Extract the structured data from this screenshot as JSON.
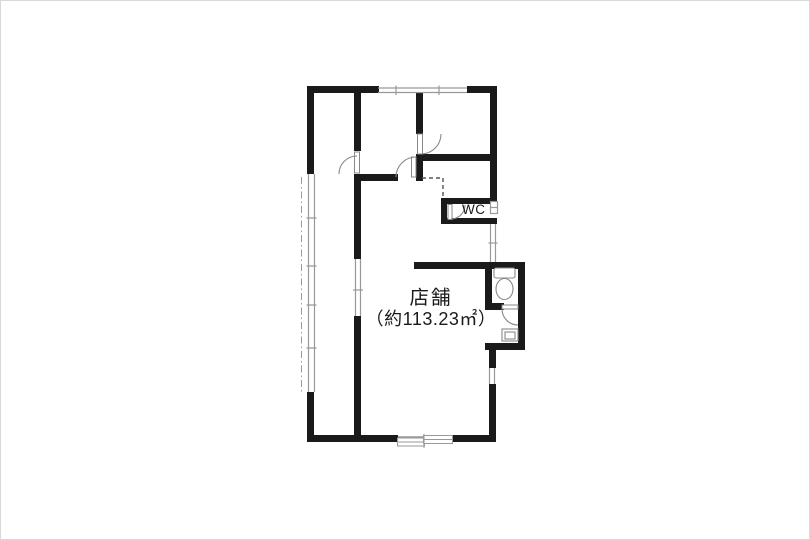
{
  "floorplan": {
    "room_label": "店舗",
    "room_area": "（約113.23㎡）",
    "wc_label": "WC",
    "colors": {
      "wall": "#1a1a1a",
      "window": "#999999",
      "door": "#888888",
      "dash": "#555555",
      "bg": "#ffffff",
      "frame": "#d9d9d9",
      "text": "#1a1a1a"
    }
  }
}
